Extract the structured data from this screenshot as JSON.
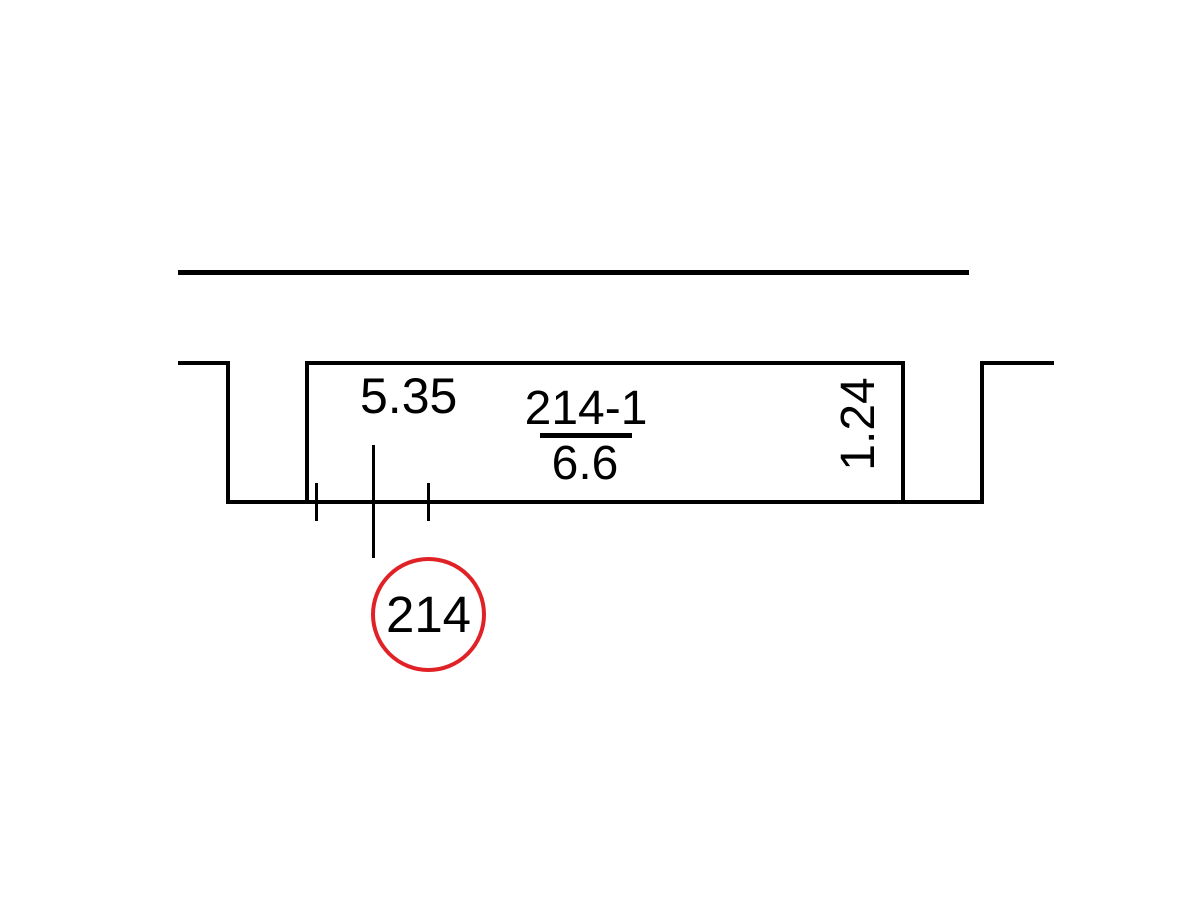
{
  "drawing": {
    "type": "floor-plan-detail",
    "colors": {
      "background": "#ffffff",
      "line": "#000000",
      "callout_red": "#e02227"
    },
    "labels": {
      "dim_width": "5.35",
      "room_number": "214-1",
      "room_area": "6.6",
      "dim_depth": "1.24",
      "callout": "214"
    }
  }
}
